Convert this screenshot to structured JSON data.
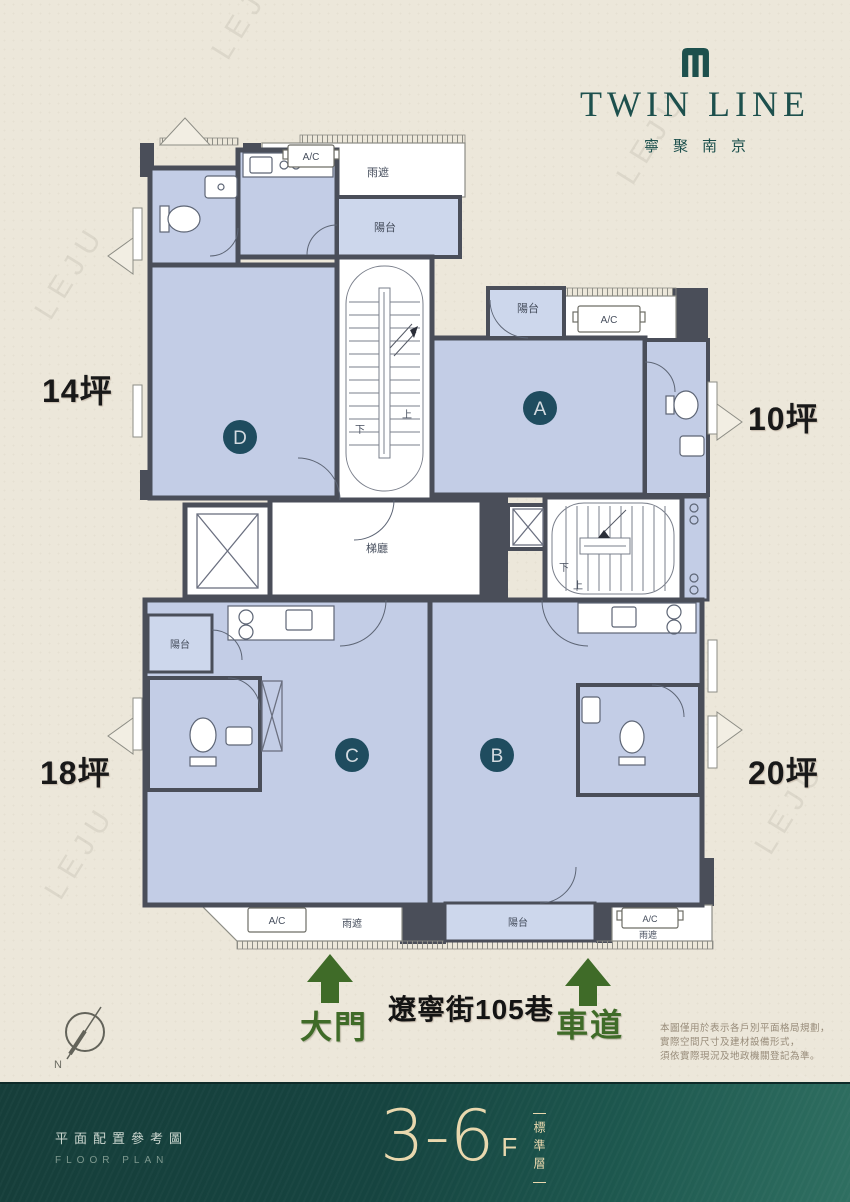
{
  "logo": {
    "title": "TWIN LINE",
    "subtitle": "寧聚南京"
  },
  "plan": {
    "units": [
      {
        "id": "A",
        "area_label": "10坪"
      },
      {
        "id": "B",
        "area_label": "20坪"
      },
      {
        "id": "C",
        "area_label": "18坪"
      },
      {
        "id": "D",
        "area_label": "14坪"
      }
    ],
    "labels": {
      "balcony": "陽台",
      "rain_cover": "雨遮",
      "ac": "A/C",
      "elevator_hall": "梯廳",
      "up": "上",
      "down": "下"
    }
  },
  "street": {
    "name": "遼寧街105巷",
    "main_gate": "大門",
    "driveway": "車道"
  },
  "compass": {
    "north": "N"
  },
  "disclaimer": {
    "line1": "本圖僅用於表示各戶別平面格局規劃，",
    "line2": "實際空間尺寸及建材設備形式，",
    "line3": "須依實際現況及地政機關登記為準。"
  },
  "footer": {
    "caption_zh": "平面配置參考圖",
    "caption_en": "FLOOR PLAN",
    "floor_range": "3-6",
    "floor_unit": "F",
    "floor_type": "標準層"
  },
  "watermark": {
    "text": "LEJU"
  },
  "colors": {
    "accent_teal": "#1d504d",
    "unit_circle": "#1f4c5f",
    "room_blue": "#c3cde6",
    "balcony_blue": "#cdd7ec",
    "wall": "#4a4e59",
    "arrow_green": "#3f6b28",
    "background_cream": "#ece7da",
    "footer_gold": "#e9d8ae",
    "footer_teal": "#1d574e"
  }
}
